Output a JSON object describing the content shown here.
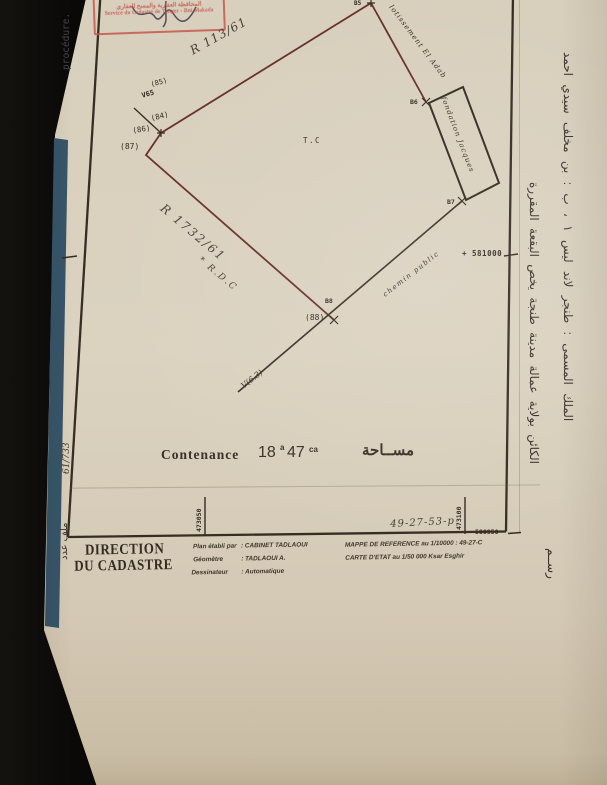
{
  "stamp": {
    "line1": "المحافظة العقارية والمسح العقاري",
    "line2": "Service du Cadastre de Tanger - Bni Makada"
  },
  "left_margin": {
    "procedure": "procédure.",
    "file_no": "61/733",
    "file_label": "ملف عدد"
  },
  "plan": {
    "edge_r113": "R 113/61",
    "edge_r1732": "R 1732/61",
    "rdc": "* R.D.C",
    "tc": "T.C",
    "lotissement": "lotissement  El  Adab",
    "fondation": "fondation  Jacques",
    "chemin": "chemin  public",
    "v63": "V(6.3)",
    "v65": "V65",
    "pt85": "(85)",
    "pt84": "(84)",
    "pt86": "(86)",
    "pt87": "(87)",
    "pt88": "(88)",
    "b5": "B5",
    "b6": "B6",
    "b7": "B7",
    "b8": "B8",
    "y_line": "+ 581000",
    "x_tick1": "473050",
    "x_tick2": "473100",
    "sheet_ref": "49-27-53-p",
    "y_corner": "580950"
  },
  "contenance": {
    "label": "Contenance",
    "ha": "18",
    "a_unit": "a",
    "a_val": "47",
    "ca_unit": "ca",
    "arabic": "مســاحة"
  },
  "title_block": {
    "org1": "DIRECTION",
    "org2": "DU CADASTRE",
    "row1_label": "Plan établi par",
    "row1_value": ": CABINET TADLAOUI",
    "row2_label": "Géomètre",
    "row2_value": ": TADLAOUI A.",
    "row3_label": "Dessinateur",
    "row3_value": ": Automatique",
    "ref1": "MAPPE DE REFERENCE au 1/10000 : 49-27-C",
    "ref2": "CARTE D'ETAT au 1/50 000  Ksar Esghir"
  },
  "right_margin": {
    "col1": "الملك المسمى : طنجر لاند ليس ١ ، ب : بن مخلف سيدي احمد",
    "col2": "الكائن بولاية عمالة مدينة طنجة يخص البقعة المقررة",
    "col3": "رســم"
  }
}
